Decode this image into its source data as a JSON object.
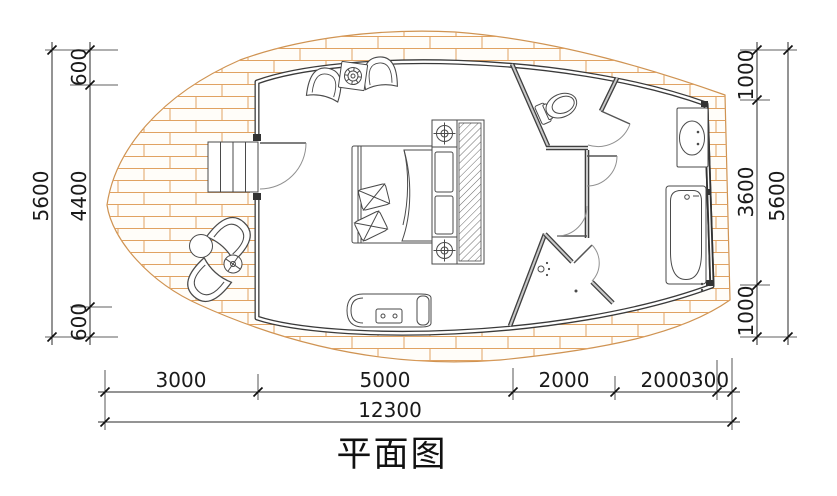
{
  "title": "平面图",
  "drawing_type": "floor-plan",
  "dimensions": {
    "left": {
      "total": "5600",
      "segments": [
        "600",
        "4400",
        "600"
      ]
    },
    "right": {
      "total": "5600",
      "segments": [
        "1000",
        "3600",
        "1000"
      ]
    },
    "bottom": {
      "segments": [
        "3000",
        "5000",
        "2000",
        "2000",
        "300"
      ],
      "total": "12300"
    }
  },
  "furniture_icons": [
    "entry-stairs-icon",
    "entry-door-icon",
    "deck-armchair-icon",
    "deck-round-table-icon",
    "deck-side-table-icon",
    "armchair-icon",
    "plant-table-icon",
    "double-bed-icon",
    "pillow-icon",
    "duvet-icon",
    "wardrobe-icon",
    "bedside-lamp-icon",
    "bench-icon",
    "toilet-icon",
    "washbasin-icon",
    "bathtub-icon",
    "shower-head-icon",
    "floor-drain-icon"
  ],
  "colors": {
    "wall": "#3a3a3a",
    "deck_line": "#df9f60",
    "dimension": "#2a2a2a",
    "background": "#ffffff"
  }
}
